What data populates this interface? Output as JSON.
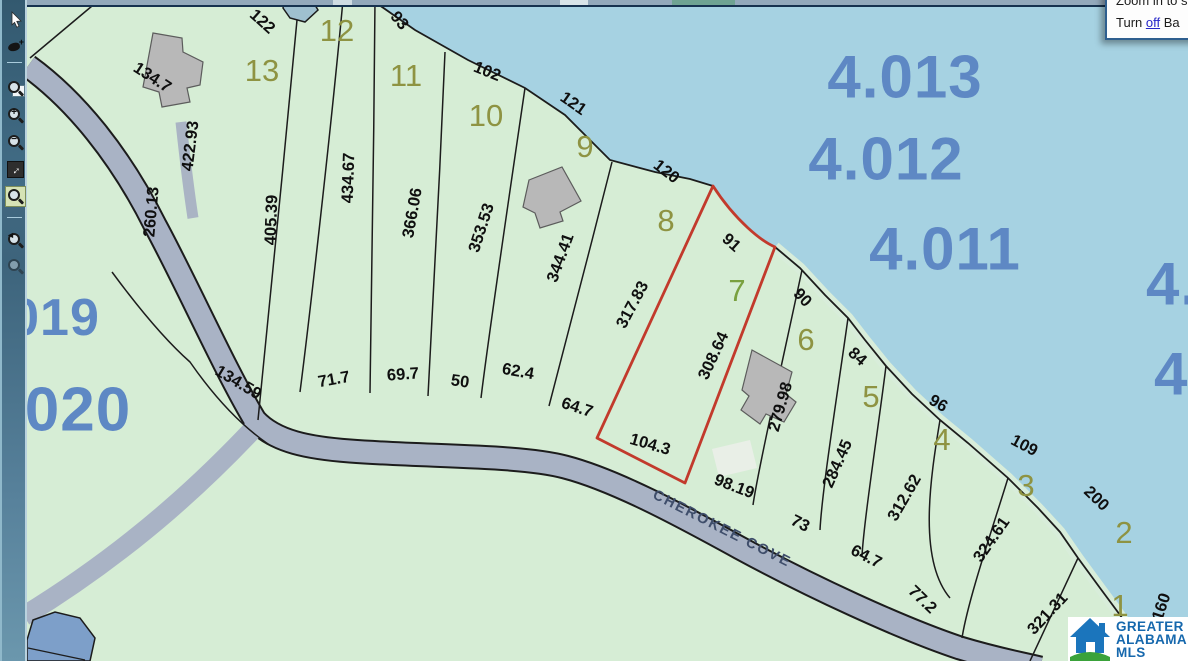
{
  "popup": {
    "line1": "Zoom in to se",
    "line2_pre": "Turn ",
    "line2_link": "off",
    "line2_post": " Ba"
  },
  "left_toolbar": {
    "tools": [
      {
        "name": "select-arrow"
      },
      {
        "name": "sketch-tool",
        "badge": "+"
      },
      {
        "name": "zoom-window"
      },
      {
        "name": "zoom-in",
        "overlay": "+"
      },
      {
        "name": "zoom-out",
        "overlay": "−"
      },
      {
        "name": "full-extent",
        "glyph": "↔"
      },
      {
        "name": "zoom-selected"
      },
      {
        "name": "previous-extent",
        "back": "◄"
      },
      {
        "name": "next-extent"
      }
    ]
  },
  "map": {
    "road_label": "CHEROKEE COVE",
    "highlight_color": "#c23a2c",
    "water_color": "#a6d2e2",
    "land_color": "#d6edd5",
    "road_color": "#a9b3c5",
    "dimensions": [
      {
        "text": "134.7",
        "x": 152,
        "y": 78,
        "rot": 33
      },
      {
        "text": "422.93",
        "x": 191,
        "y": 146,
        "rot": -83
      },
      {
        "text": "260.13",
        "x": 152,
        "y": 212,
        "rot": -85
      },
      {
        "text": "122",
        "x": 262,
        "y": 22,
        "rot": 42
      },
      {
        "text": "405.39",
        "x": 272,
        "y": 220,
        "rot": -88
      },
      {
        "text": "434.67",
        "x": 349,
        "y": 178,
        "rot": -88
      },
      {
        "text": "93",
        "x": 399,
        "y": 21,
        "rot": 50
      },
      {
        "text": "366.06",
        "x": 413,
        "y": 213,
        "rot": -80
      },
      {
        "text": "102",
        "x": 487,
        "y": 72,
        "rot": 22
      },
      {
        "text": "353.53",
        "x": 482,
        "y": 228,
        "rot": -72
      },
      {
        "text": "121",
        "x": 573,
        "y": 104,
        "rot": 35
      },
      {
        "text": "344.41",
        "x": 561,
        "y": 258,
        "rot": -70
      },
      {
        "text": "120",
        "x": 666,
        "y": 172,
        "rot": 38
      },
      {
        "text": "317.83",
        "x": 633,
        "y": 305,
        "rot": -62
      },
      {
        "text": "91",
        "x": 731,
        "y": 243,
        "rot": 42
      },
      {
        "text": "90",
        "x": 802,
        "y": 298,
        "rot": 47
      },
      {
        "text": "308.64",
        "x": 714,
        "y": 356,
        "rot": -65
      },
      {
        "text": "279.98",
        "x": 781,
        "y": 407,
        "rot": -74
      },
      {
        "text": "84",
        "x": 857,
        "y": 357,
        "rot": 42
      },
      {
        "text": "96",
        "x": 938,
        "y": 404,
        "rot": 30
      },
      {
        "text": "284.45",
        "x": 838,
        "y": 464,
        "rot": -66
      },
      {
        "text": "109",
        "x": 1024,
        "y": 446,
        "rot": 28
      },
      {
        "text": "312.62",
        "x": 905,
        "y": 498,
        "rot": -60
      },
      {
        "text": "200",
        "x": 1096,
        "y": 499,
        "rot": 44
      },
      {
        "text": "324.61",
        "x": 992,
        "y": 540,
        "rot": -55
      },
      {
        "text": "321.31",
        "x": 1048,
        "y": 614,
        "rot": -47
      },
      {
        "text": "160",
        "x": 1162,
        "y": 607,
        "rot": -72
      },
      {
        "text": "134.59",
        "x": 238,
        "y": 383,
        "rot": 31
      },
      {
        "text": "71.7",
        "x": 334,
        "y": 380,
        "rot": -10
      },
      {
        "text": "69.7",
        "x": 403,
        "y": 375,
        "rot": -4
      },
      {
        "text": "50",
        "x": 460,
        "y": 382,
        "rot": 8
      },
      {
        "text": "62.4",
        "x": 518,
        "y": 372,
        "rot": 10
      },
      {
        "text": "64.7",
        "x": 577,
        "y": 408,
        "rot": 18
      },
      {
        "text": "104.3",
        "x": 650,
        "y": 445,
        "rot": 16
      },
      {
        "text": "98.19",
        "x": 734,
        "y": 487,
        "rot": 21
      },
      {
        "text": "73",
        "x": 800,
        "y": 524,
        "rot": 27
      },
      {
        "text": "64.7",
        "x": 866,
        "y": 557,
        "rot": 27
      },
      {
        "text": "77.2",
        "x": 922,
        "y": 600,
        "rot": 44
      }
    ],
    "lot_numbers": [
      {
        "text": "13",
        "x": 262,
        "y": 71
      },
      {
        "text": "12",
        "x": 337,
        "y": 31
      },
      {
        "text": "11",
        "x": 406,
        "y": 76
      },
      {
        "text": "10",
        "x": 486,
        "y": 116
      },
      {
        "text": "9",
        "x": 585,
        "y": 147
      },
      {
        "text": "8",
        "x": 666,
        "y": 221
      },
      {
        "text": "7",
        "x": 737,
        "y": 291,
        "color": "#79a03f"
      },
      {
        "text": "6",
        "x": 806,
        "y": 340
      },
      {
        "text": "5",
        "x": 871,
        "y": 397
      },
      {
        "text": "4",
        "x": 942,
        "y": 440
      },
      {
        "text": "3",
        "x": 1026,
        "y": 486
      },
      {
        "text": "2",
        "x": 1124,
        "y": 533
      },
      {
        "text": "1",
        "x": 1120,
        "y": 606
      }
    ],
    "parcel_ids": [
      {
        "text": "4.013",
        "x": 905,
        "y": 77,
        "size": 60
      },
      {
        "text": "4.012",
        "x": 886,
        "y": 159,
        "size": 60
      },
      {
        "text": "4.011",
        "x": 945,
        "y": 249,
        "size": 60
      },
      {
        "text": "4.",
        "x": 1172,
        "y": 284,
        "size": 60
      },
      {
        "text": "4.",
        "x": 1180,
        "y": 374,
        "size": 60
      },
      {
        "text": "019",
        "x": 55,
        "y": 318,
        "size": 52
      },
      {
        "text": "020",
        "x": 78,
        "y": 410,
        "size": 62
      }
    ]
  },
  "logo": {
    "line1": "GREATER",
    "line2": "ALABAMA",
    "line3": "MLS",
    "blue": "#1b75bc",
    "green": "#3aa23a"
  }
}
